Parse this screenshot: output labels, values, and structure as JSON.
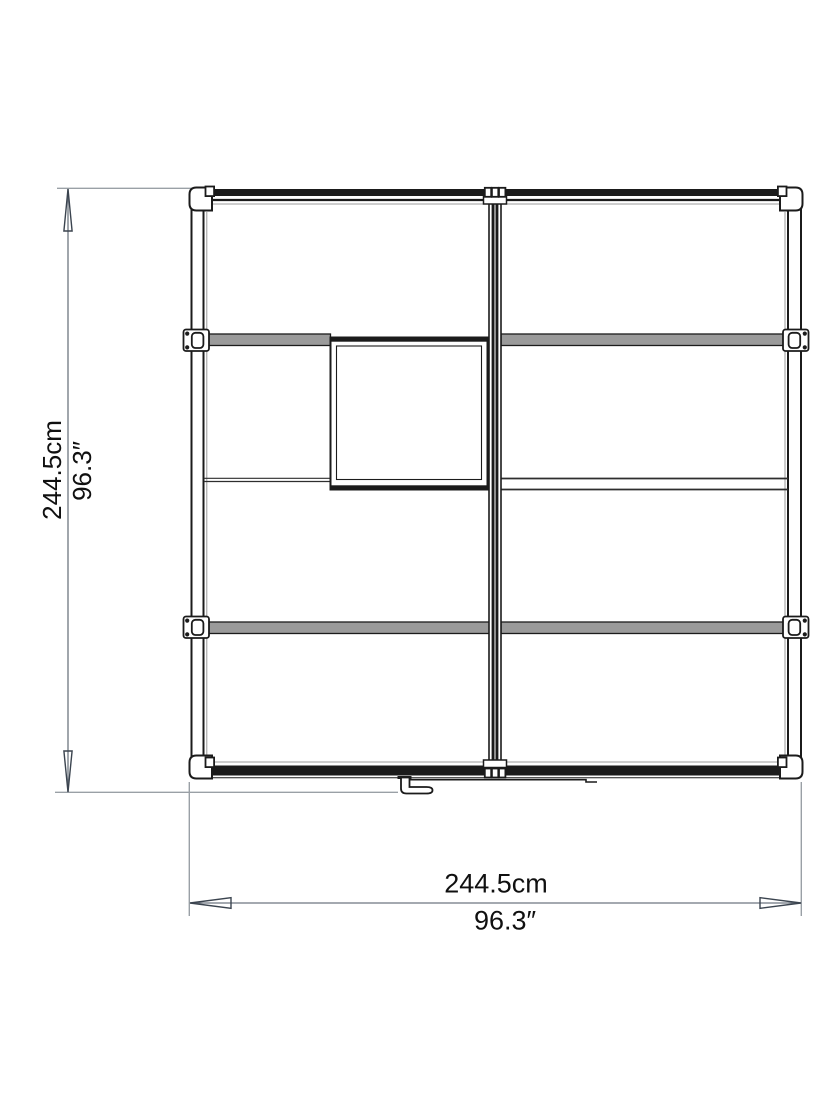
{
  "dimension_labels": {
    "left": {
      "metric": "244.5cm",
      "imperial": "96.3″"
    },
    "bottom": {
      "metric": "244.5cm",
      "imperial": "96.3″"
    }
  },
  "colors": {
    "background": "#ffffff",
    "ink": "#1b1b1b",
    "bar_fill": "#9a9a9a",
    "panel_line": "#2e2e2e",
    "faint_line": "#9b9b9b",
    "ext_line": "#9aa0a6",
    "dim_line": "#6e7680",
    "dim_arrow": "#3b444f",
    "text": "#101010"
  }
}
